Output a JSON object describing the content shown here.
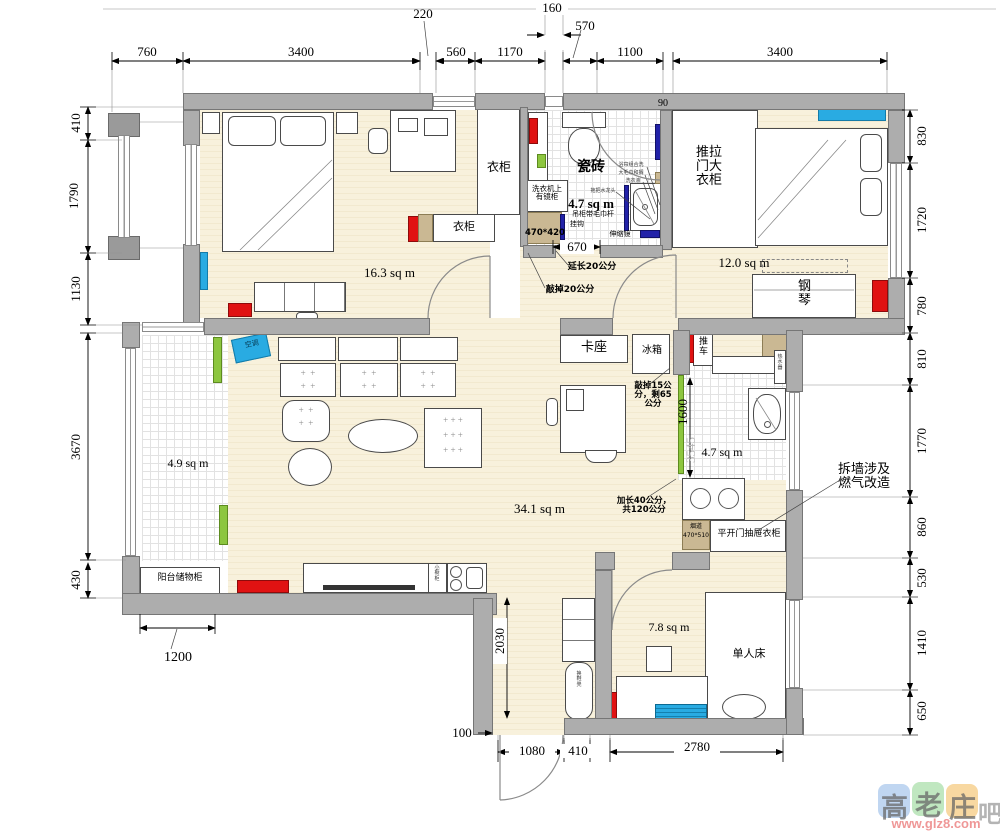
{
  "rooms": {
    "bedroom1": "16.3 sq m",
    "bathroom": "4.7 sq m",
    "bedroom2": "12.0 sq m",
    "balcony": "4.9 sq m",
    "living": "34.1 sq m",
    "kitchen": "4.7 sq m",
    "small_room": "7.8 sq m"
  },
  "dims": {
    "top": {
      "d760": "760",
      "d3400a": "3400",
      "d220": "220",
      "d560": "560",
      "d1170": "1170",
      "d160": "160",
      "d570": "570",
      "d1100": "1100",
      "d3400b": "3400"
    },
    "left": {
      "d410": "410",
      "d1790": "1790",
      "d1130": "1130",
      "d3670": "3670",
      "d430": "430"
    },
    "right": {
      "d830": "830",
      "d1720": "1720",
      "d780": "780",
      "d810": "810",
      "d1770": "1770",
      "d860": "860",
      "d530": "530",
      "d1410": "1410",
      "d650": "650"
    },
    "bottom": {
      "d100": "100",
      "d1080": "1080",
      "d410": "410",
      "d2780": "2780",
      "d1200": "1200"
    },
    "inner": {
      "d670": "670",
      "d1600": "1600",
      "d2030": "2030",
      "d90": "90",
      "d3545": "3545"
    }
  },
  "labels": {
    "wardrobe_tall": "衣柜",
    "wardrobe_low": "衣柜",
    "tile_note": "瓷砖",
    "washer": "洗衣机上有镜柜",
    "washer_cab_size": "470*420",
    "hanging_cabinet": "吊柜带毛巾杆",
    "hooks": "挂钩",
    "telescopic_mirror": "伸缩镜",
    "extend_20": "延长20公分",
    "knock_off_20": "敲掉20公分",
    "sliding_wardrobe": "推拉门大衣柜",
    "piano": "钢琴",
    "air_conditioner": "空调",
    "booth_seat": "卡座",
    "fridge": "冰箱",
    "cart": "推车",
    "water_heater": "热水器",
    "knock_off_15": "敲掉15公分，剩65公分",
    "lengthen_40": "加长40公分，共120公分",
    "flue": "烟道",
    "flue_size": "470*510",
    "drawer_wardrobe": "平开门抽屉衣柜",
    "demolish_note": "拆墙涉及燃气改造",
    "balcony_storage": "阳台储物柜",
    "shoe_bench": "换鞋凳",
    "small_cabinet": "小橱柜",
    "single_bed": "单人床",
    "bath_note1": "浴帘组合洗",
    "bath_note2": "大毛巾和搁",
    "bath_note3": "洗衣液",
    "bath_note4": "拖把水龙头"
  },
  "watermark": {
    "char1": "高",
    "char2": "老",
    "char3": "庄",
    "char4": "吧",
    "url": "www.glz8.com"
  },
  "colors": {
    "wall": "#adadad",
    "floor": "#f6eed8",
    "red": "#e01212",
    "green": "#8dc63f",
    "cyan": "#29abe2",
    "tan": "#cab893"
  }
}
